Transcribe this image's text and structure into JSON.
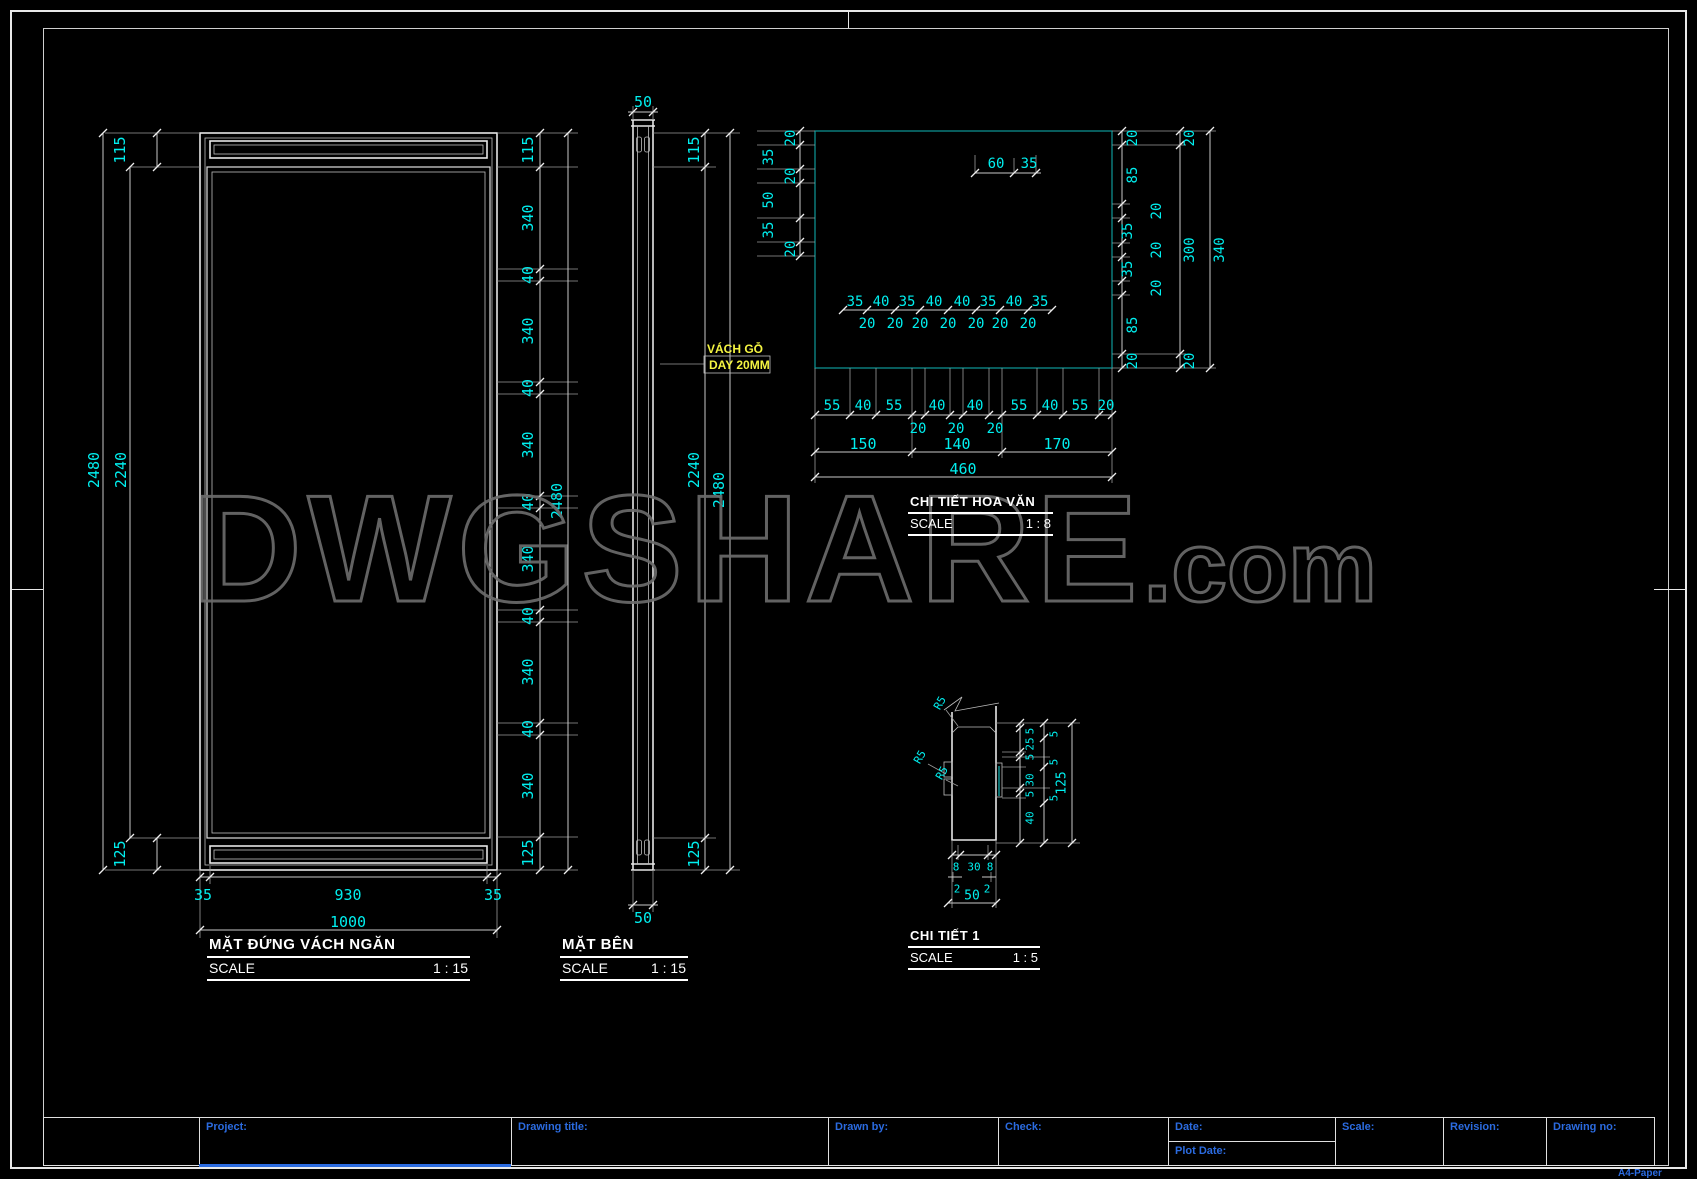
{
  "sheet": {
    "paper_label": "A4-Paper"
  },
  "watermark": {
    "main": "DWGSHARE",
    "suffix": ".com"
  },
  "colors": {
    "dim_text": "#00efef",
    "note_yellow": "#f5f542",
    "label_blue": "#2b6be0",
    "detail_border": "#0e9a9a"
  },
  "front_elevation": {
    "title": "MẶT ĐỨNG VÁCH NGĂN",
    "scale_label": "SCALE",
    "scale_value": "1 : 15",
    "left": {
      "seg_top": "115",
      "overall": "2480",
      "inner": "2240",
      "seg_bottom": "125"
    },
    "right_chain": [
      "115",
      "340",
      "40",
      "340",
      "40",
      "340",
      "40",
      "340",
      "40",
      "340",
      "40",
      "340",
      "125"
    ],
    "right_overall": "2480",
    "bottom_chain": [
      "35",
      "930",
      "35"
    ],
    "bottom_overall": "1000"
  },
  "side_view": {
    "title": "MẶT BÊN",
    "scale_label": "SCALE",
    "scale_value": "1 : 15",
    "top_width": "50",
    "bottom_width": "50",
    "right": {
      "seg_top": "115",
      "inner": "2240",
      "overall": "2480",
      "seg_bottom": "125"
    },
    "note": {
      "line1": "VÁCH GỖ",
      "line2": "DAY 20MM"
    }
  },
  "pattern_detail": {
    "title": "CHI TIẾT HOA VĂN",
    "scale_label": "SCALE",
    "scale_value": "1 : 8",
    "left_chain": [
      "20",
      "35",
      "20",
      "50",
      "35",
      "20"
    ],
    "top_dims": [
      "60",
      "35"
    ],
    "mid_chain": [
      "35",
      "40",
      "35",
      "40",
      "40",
      "35",
      "40",
      "35"
    ],
    "mid_sub": [
      "20",
      "20",
      "20",
      "20",
      "20",
      "20",
      "20"
    ],
    "right_chain": [
      "20",
      "85",
      "20",
      "35",
      "20",
      "35",
      "20",
      "85",
      "20"
    ],
    "right_mid": [
      "20",
      "300",
      "20"
    ],
    "right_overall": "340",
    "bottom_row1": [
      "55",
      "40",
      "55",
      "40",
      "40",
      "55",
      "40",
      "55",
      "20"
    ],
    "bottom_row2": [
      "20",
      "20",
      "20"
    ],
    "bottom_row3": [
      "150",
      "140",
      "170"
    ],
    "bottom_overall": "460"
  },
  "detail_1": {
    "title": "CHI TIẾT 1",
    "scale_label": "SCALE",
    "scale_value": "1 : 5",
    "radii": [
      "R5",
      "R5",
      "R5"
    ],
    "right_chain": [
      "5",
      "25",
      "5",
      "30",
      "5",
      "40"
    ],
    "right_sub": [
      "5",
      "5",
      "5"
    ],
    "right_overall": "125",
    "bottom_chain": [
      "8",
      "30",
      "8"
    ],
    "bottom_sub": [
      "2",
      "2"
    ],
    "bottom_overall": "50"
  },
  "title_block": {
    "project": "Project:",
    "drawing_title": "Drawing title:",
    "drawn_by": "Drawn by:",
    "check": "Check:",
    "date": "Date:",
    "plot_date": "Plot Date:",
    "scale": "Scale:",
    "revision": "Revision:",
    "drawing_no": "Drawing no:"
  }
}
